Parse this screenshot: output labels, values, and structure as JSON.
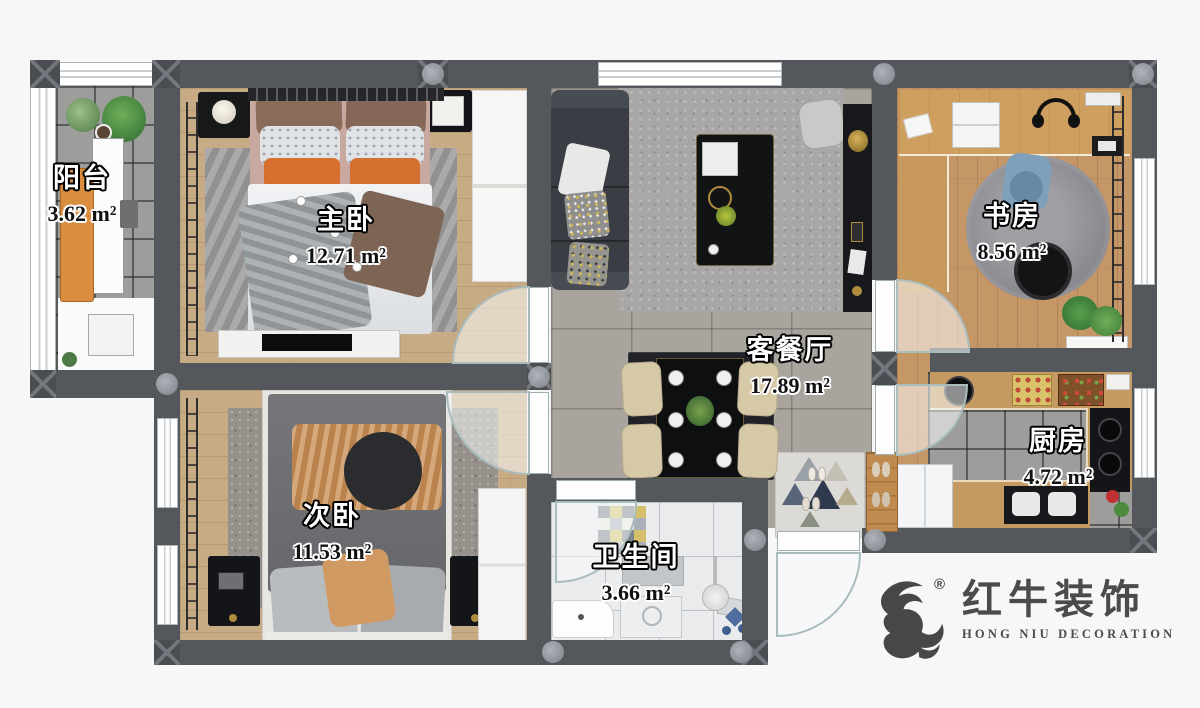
{
  "rooms": [
    {
      "id": "balcony",
      "name": "阳台",
      "area": "3.62 m²"
    },
    {
      "id": "master-bedroom",
      "name": "主卧",
      "area": "12.71 m²"
    },
    {
      "id": "second-bedroom",
      "name": "次卧",
      "area": "11.53 m²"
    },
    {
      "id": "study",
      "name": "书房",
      "area": "8.56 m²"
    },
    {
      "id": "living-dining",
      "name": "客餐厅",
      "area": "17.89 m²"
    },
    {
      "id": "kitchen",
      "name": "厨房",
      "area": "4.72 m²"
    },
    {
      "id": "bathroom",
      "name": "卫生间",
      "area": "3.66 m²"
    }
  ],
  "logo": {
    "zh": "红牛装饰",
    "en": "HONG NIU DECORATION",
    "registered": "®"
  },
  "palette": {
    "wall": "#54575c",
    "wood_floor": "#c7ab85",
    "study_wood": "#c59767",
    "tile_gray": "#a9a59e",
    "tile_dark": "#9d9d9b",
    "bath_tile": "#eaebed",
    "accent_orange": "#d97a2e"
  }
}
